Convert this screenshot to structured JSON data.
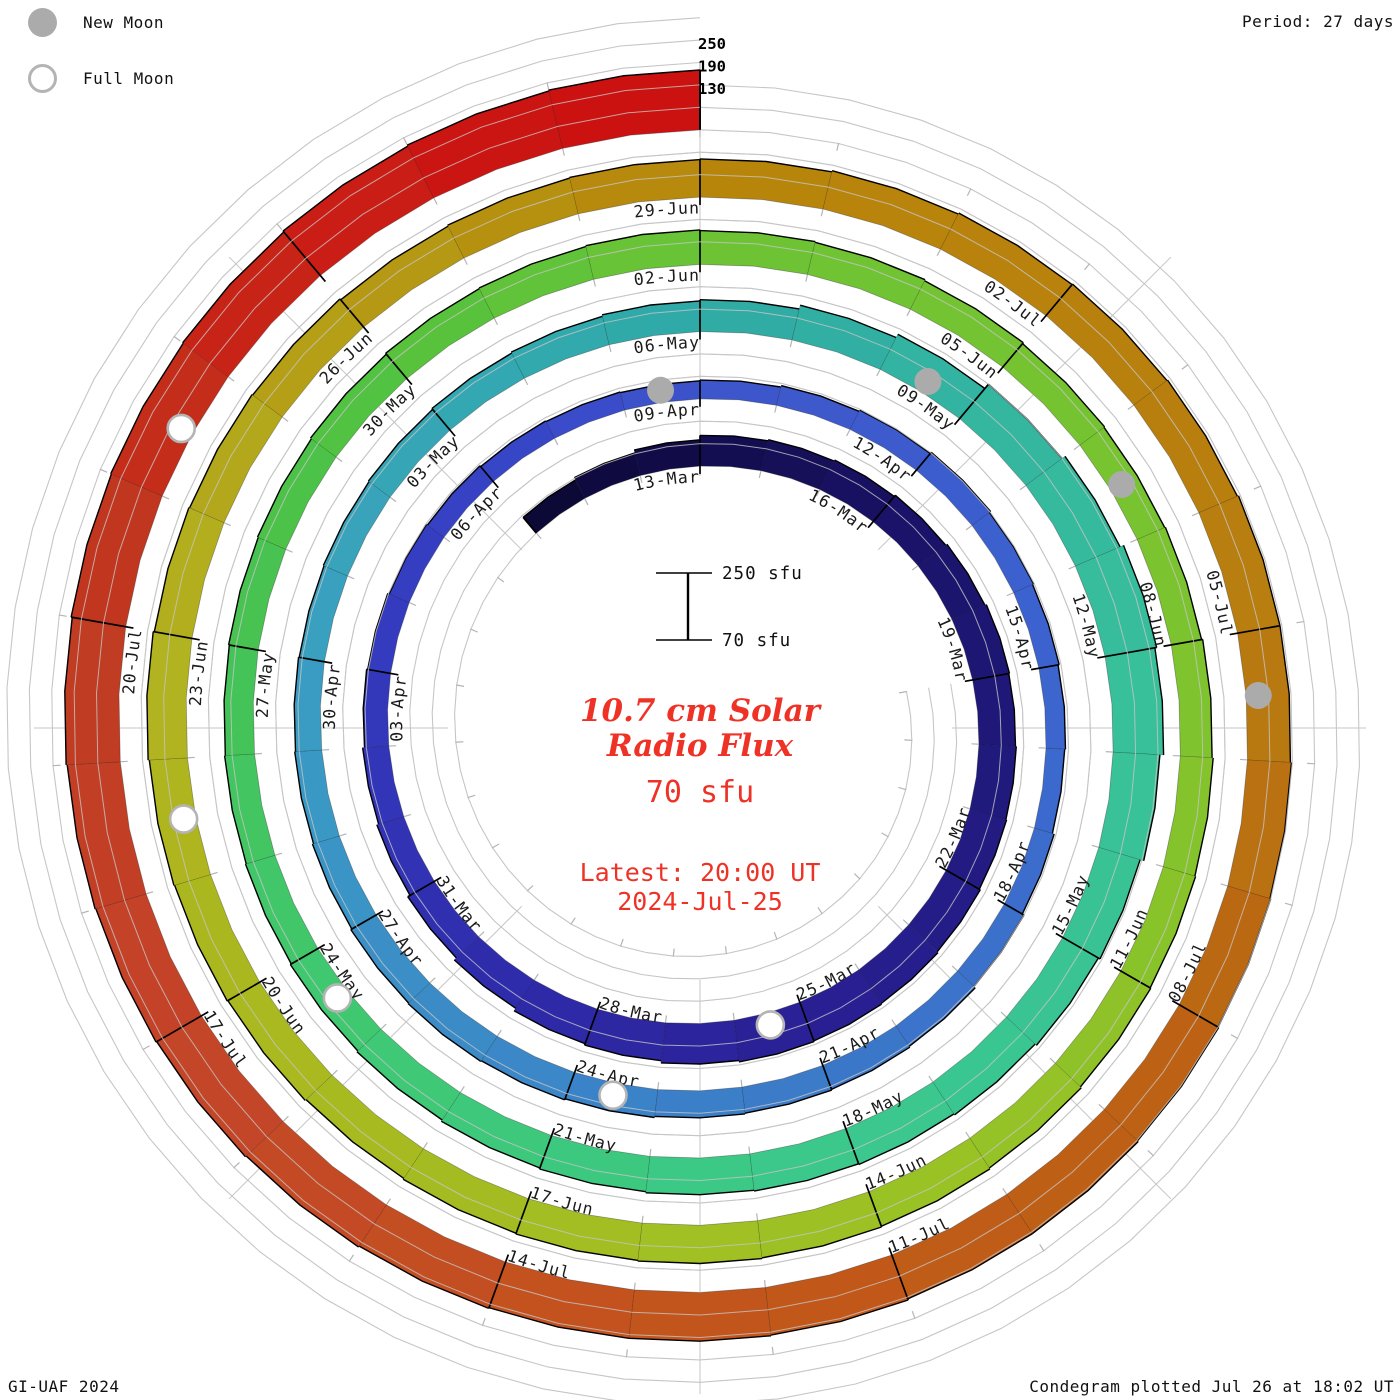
{
  "legend": {
    "new_moon_label": "New Moon",
    "full_moon_label": "Full Moon"
  },
  "header": {
    "period_label": "Period: 27 days"
  },
  "footer": {
    "credit": "GI-UAF 2024",
    "plotted": "Condegram plotted Jul 26 at 18:02 UT"
  },
  "center": {
    "title_line1": "10.7 cm Solar",
    "title_line2": "Radio Flux",
    "flux_value": "70 sfu",
    "latest_line1": "Latest: 20:00 UT",
    "latest_line2": "2024-Jul-25",
    "scale_top_label": "250 sfu",
    "scale_bottom_label": "70 sfu"
  },
  "colors": {
    "accent_red": "#ee3226",
    "guide_gray": "#c6c6c6",
    "tick_gray": "#b4b4b4",
    "moon_gray": "#ababab",
    "text_black": "#111111"
  },
  "chart_data": {
    "type": "bar",
    "subtype": "spiral-condegram",
    "title": "10.7 cm Solar Radio Flux",
    "units": "sfu",
    "period_days": 27,
    "direction": "clockwise",
    "rotation_alignment": "top",
    "start_date": "2024-03-10",
    "end_date": "2024-07-25",
    "flux_baseline": 70,
    "flux_top": 250,
    "radial_gridlines_sfu": [
      70,
      130,
      190,
      250
    ],
    "radial_axis_labels": [
      "250",
      "190",
      "130"
    ],
    "rotation_start_dates": [
      "13-Mar",
      "09-Apr",
      "06-May",
      "02-Jun",
      "29-Jun"
    ],
    "flux_by_day": [
      125,
      132,
      140,
      152,
      155,
      158,
      162,
      166,
      170,
      168,
      170,
      172,
      175,
      178,
      180,
      182,
      178,
      172,
      168,
      160,
      152,
      145,
      140,
      135,
      132,
      128,
      125,
      122,
      120,
      118,
      120,
      124,
      128,
      132,
      128,
      125,
      122,
      120,
      125,
      130,
      135,
      138,
      140,
      142,
      145,
      148,
      150,
      148,
      145,
      142,
      140,
      138,
      140,
      142,
      145,
      148,
      152,
      155,
      165,
      175,
      190,
      200,
      210,
      205,
      195,
      185,
      180,
      175,
      172,
      170,
      168,
      165,
      162,
      158,
      155,
      152,
      150,
      148,
      150,
      152,
      155,
      158,
      160,
      162,
      160,
      158,
      155,
      152,
      150,
      152,
      155,
      158,
      160,
      162,
      165,
      168,
      170,
      172,
      170,
      168,
      165,
      168,
      170,
      172,
      175,
      172,
      170,
      168,
      165,
      168,
      170,
      172,
      175,
      178,
      180,
      182,
      185,
      185,
      188,
      190,
      192,
      195,
      195,
      198,
      200,
      200,
      202,
      205,
      208,
      210,
      212,
      215,
      218,
      220,
      222,
      225,
      228,
      230
    ],
    "date_labels": [
      {
        "t": 3,
        "label": "13-Mar"
      },
      {
        "t": 6,
        "label": "16-Mar"
      },
      {
        "t": 9,
        "label": "19-Mar"
      },
      {
        "t": 12,
        "label": "22-Mar"
      },
      {
        "t": 15,
        "label": "25-Mar"
      },
      {
        "t": 18,
        "label": "28-Mar"
      },
      {
        "t": 21,
        "label": "31-Mar"
      },
      {
        "t": 24,
        "label": "03-Apr"
      },
      {
        "t": 27,
        "label": "06-Apr"
      },
      {
        "t": 30,
        "label": "09-Apr"
      },
      {
        "t": 33,
        "label": "12-Apr"
      },
      {
        "t": 36,
        "label": "15-Apr"
      },
      {
        "t": 39,
        "label": "18-Apr"
      },
      {
        "t": 42,
        "label": "21-Apr"
      },
      {
        "t": 45,
        "label": "24-Apr"
      },
      {
        "t": 48,
        "label": "27-Apr"
      },
      {
        "t": 51,
        "label": "30-Apr"
      },
      {
        "t": 54,
        "label": "03-May"
      },
      {
        "t": 57,
        "label": "06-May"
      },
      {
        "t": 60,
        "label": "09-May"
      },
      {
        "t": 63,
        "label": "12-May"
      },
      {
        "t": 66,
        "label": "15-May"
      },
      {
        "t": 69,
        "label": "18-May"
      },
      {
        "t": 72,
        "label": "21-May"
      },
      {
        "t": 75,
        "label": "24-May"
      },
      {
        "t": 78,
        "label": "27-May"
      },
      {
        "t": 81,
        "label": "30-May"
      },
      {
        "t": 84,
        "label": "02-Jun"
      },
      {
        "t": 87,
        "label": "05-Jun"
      },
      {
        "t": 90,
        "label": "08-Jun"
      },
      {
        "t": 93,
        "label": "11-Jun"
      },
      {
        "t": 96,
        "label": "14-Jun"
      },
      {
        "t": 99,
        "label": "17-Jun"
      },
      {
        "t": 102,
        "label": "20-Jun"
      },
      {
        "t": 105,
        "label": "23-Jun"
      },
      {
        "t": 108,
        "label": "26-Jun"
      },
      {
        "t": 111,
        "label": "29-Jun"
      },
      {
        "t": 114,
        "label": "02-Jul"
      },
      {
        "t": 117,
        "label": "05-Jul"
      },
      {
        "t": 120,
        "label": "08-Jul"
      },
      {
        "t": 123,
        "label": "11-Jul"
      },
      {
        "t": 126,
        "label": "14-Jul"
      },
      {
        "t": 129,
        "label": "17-Jul"
      },
      {
        "t": 132,
        "label": "20-Jul"
      }
    ],
    "new_moons": [
      {
        "date": "08-Apr",
        "t": 29
      },
      {
        "date": "08-May",
        "t": 59
      },
      {
        "date": "06-Jun",
        "t": 88
      },
      {
        "date": "05-Jul",
        "t": 117
      }
    ],
    "full_moons": [
      {
        "date": "25-Mar",
        "t": 15
      },
      {
        "date": "23-Apr",
        "t": 44
      },
      {
        "date": "23-May",
        "t": 74
      },
      {
        "date": "21-Jun",
        "t": 103
      },
      {
        "date": "21-Jul",
        "t": 133
      }
    ],
    "color_stops": [
      {
        "t": 0,
        "c": "#0b0833"
      },
      {
        "t": 6,
        "c": "#191266"
      },
      {
        "t": 12,
        "c": "#241c84"
      },
      {
        "t": 15,
        "c": "#2a2095"
      },
      {
        "t": 21,
        "c": "#3030b2"
      },
      {
        "t": 27,
        "c": "#3642c6"
      },
      {
        "t": 30,
        "c": "#3d55cb"
      },
      {
        "t": 36,
        "c": "#3c63cf"
      },
      {
        "t": 42,
        "c": "#3b79c8"
      },
      {
        "t": 45,
        "c": "#3b85c8"
      },
      {
        "t": 51,
        "c": "#3a9ec2"
      },
      {
        "t": 54,
        "c": "#35a8b4"
      },
      {
        "t": 57,
        "c": "#2faaa5"
      },
      {
        "t": 63,
        "c": "#38bf9b"
      },
      {
        "t": 69,
        "c": "#3bc88d"
      },
      {
        "t": 75,
        "c": "#40c86e"
      },
      {
        "t": 78,
        "c": "#45c254"
      },
      {
        "t": 81,
        "c": "#55c23e"
      },
      {
        "t": 84,
        "c": "#6cc334"
      },
      {
        "t": 90,
        "c": "#7cc32f"
      },
      {
        "t": 96,
        "c": "#9cc224"
      },
      {
        "t": 102,
        "c": "#aab81e"
      },
      {
        "t": 105,
        "c": "#b2b220"
      },
      {
        "t": 108,
        "c": "#b49b15"
      },
      {
        "t": 111,
        "c": "#b8860b"
      },
      {
        "t": 117,
        "c": "#b87d10"
      },
      {
        "t": 120,
        "c": "#bc6414"
      },
      {
        "t": 123,
        "c": "#c05a18"
      },
      {
        "t": 126,
        "c": "#c35020"
      },
      {
        "t": 129,
        "c": "#c4442a"
      },
      {
        "t": 132,
        "c": "#bf3a20"
      },
      {
        "t": 134,
        "c": "#c62818"
      },
      {
        "t": 137,
        "c": "#cc1111"
      }
    ]
  }
}
